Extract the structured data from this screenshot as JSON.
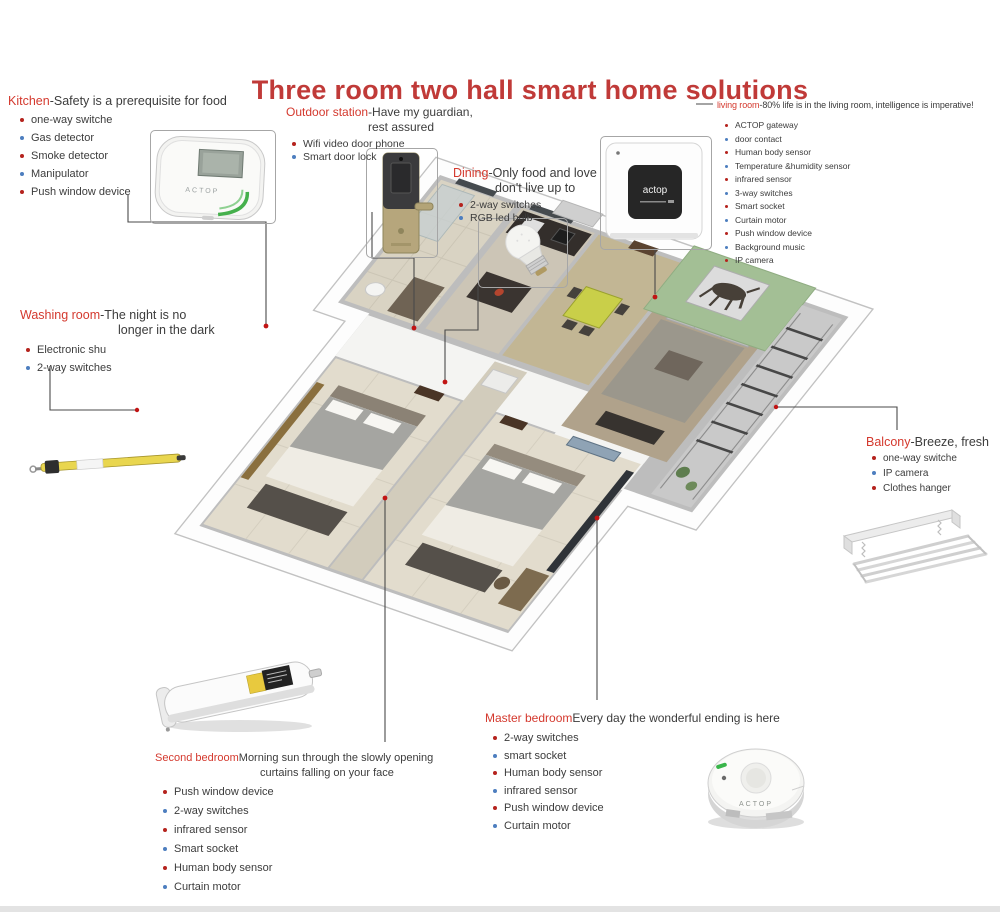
{
  "title": "Three room two hall smart home solutions",
  "colors": {
    "title_red": "#c03a38",
    "label_red": "#d4392e",
    "text_dark": "#3c3c3c",
    "bullet_red": "#b5231d",
    "bullet_blue": "#4d7ebf",
    "living_wall_green": "#a3bf95",
    "brand_green": "#3fae4a"
  },
  "sections": {
    "kitchen": {
      "name": "Kitchen",
      "desc": "-Safety is a prerequisite for food",
      "items": [
        "one-way switche",
        "Gas detector",
        "Smoke detector",
        "Manipulator",
        "Push window device"
      ]
    },
    "outdoor_station": {
      "name": "Outdoor station",
      "desc": "-Have my guardian,",
      "desc2": "rest assured",
      "items": [
        "Wifi video door phone",
        "Smart door lock"
      ]
    },
    "dining": {
      "name": "Dining",
      "desc": "-Only food and love",
      "desc2": "don't live up to",
      "items": [
        "2-way switches",
        "RGB led bulb"
      ]
    },
    "living_room": {
      "name": "living room",
      "desc": "-80% life is in the living room, intelligence is imperative!",
      "items": [
        "ACTOP gateway",
        "door contact",
        "Human body sensor",
        "Temperature &humidity sensor",
        "infrared sensor",
        "3-way switches",
        "Smart socket",
        "Curtain motor",
        "Push window device",
        "Background music",
        "IP camera"
      ]
    },
    "washing_room": {
      "name": "Washing room",
      "desc": "-The night is no",
      "desc2": "longer in the dark",
      "items": [
        "Electronic shu",
        "2-way switches"
      ]
    },
    "balcony": {
      "name": "Balcony",
      "desc": "-Breeze, fresh",
      "items": [
        "one-way switche",
        "IP camera",
        "Clothes hanger"
      ]
    },
    "second_bedroom": {
      "name": "Second bedroom",
      "desc": "Morning sun through the slowly opening",
      "desc2": "curtains falling on your face",
      "items": [
        "Push window device",
        "2-way switches",
        "infrared sensor",
        "Smart socket",
        "Human body sensor",
        "Curtain motor"
      ]
    },
    "master_bedroom": {
      "name": "Master bedroom",
      "desc": "Every day the wonderful ending is here",
      "items": [
        "2-way switches",
        "smart socket",
        "Human body sensor",
        "infrared sensor",
        "Push window device",
        "Curtain motor"
      ]
    }
  },
  "products": {
    "gateway_brand": "ACTOP",
    "wall_switch_brand": "actop",
    "ceiling_sensor_brand": "ACTOP"
  }
}
